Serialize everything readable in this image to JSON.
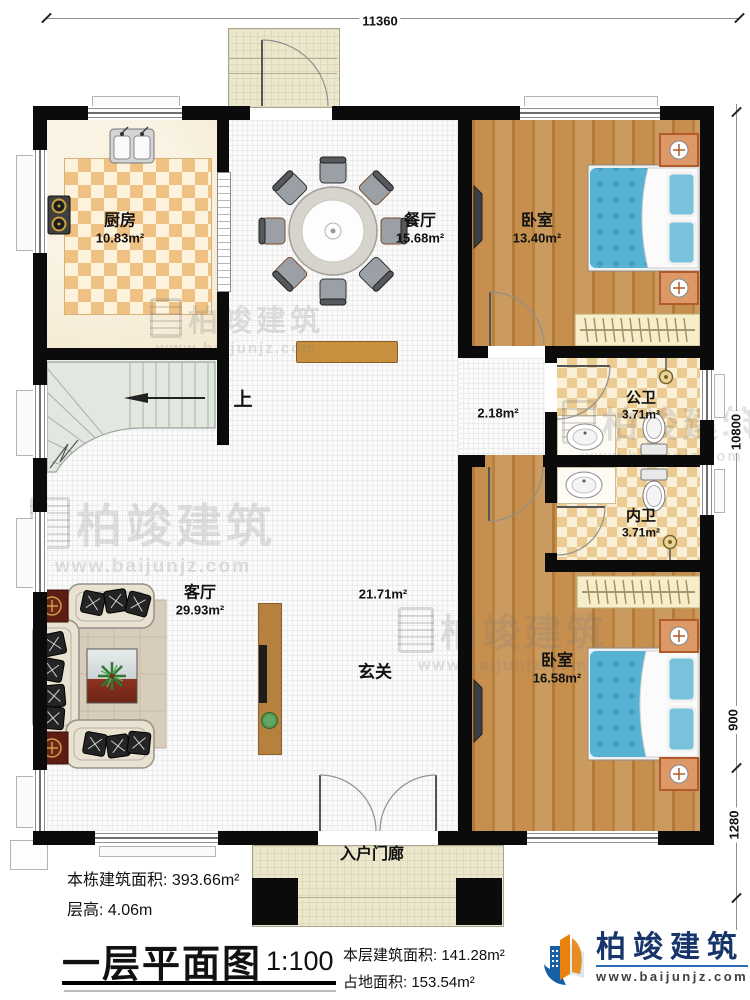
{
  "dimensions": {
    "top": "11360",
    "right_upper": "10800",
    "right_mid": "900",
    "right_lower": "1280"
  },
  "rooms": {
    "kitchen": {
      "name": "厨房",
      "area": "10.83m²"
    },
    "dining": {
      "name": "餐厅",
      "area": "15.68m²"
    },
    "bedroom1": {
      "name": "卧室",
      "area": "13.40m²"
    },
    "bath_public": {
      "name": "公卫",
      "area": "3.71m²"
    },
    "bath_private": {
      "name": "内卫",
      "area": "3.71m²"
    },
    "bedroom2": {
      "name": "卧室",
      "area": "16.58m²"
    },
    "living": {
      "name": "客厅",
      "area": "29.93m²"
    },
    "foyer": {
      "name": "玄关",
      "area": "21.71m²"
    },
    "hallway": {
      "area": "2.18m²"
    },
    "porch": {
      "name": "入户门廊"
    },
    "stairs": {
      "up_label": "上"
    }
  },
  "footer": {
    "total_area_label": "本栋建筑面积:",
    "total_area_value": "393.66m²",
    "floor_height_label": "层高:",
    "floor_height_value": "4.06m",
    "title": "一层平面图",
    "scale": "1:100",
    "floor_area_label": "本层建筑面积:",
    "floor_area_value": "141.28m²",
    "land_area_label": "占地面积:",
    "land_area_value": "153.54m²"
  },
  "logo": {
    "name": "柏竣建筑",
    "url": "www.baijunjz.com"
  },
  "watermark": {
    "name": "柏竣建筑",
    "url": "www.baijunjz.com"
  }
}
